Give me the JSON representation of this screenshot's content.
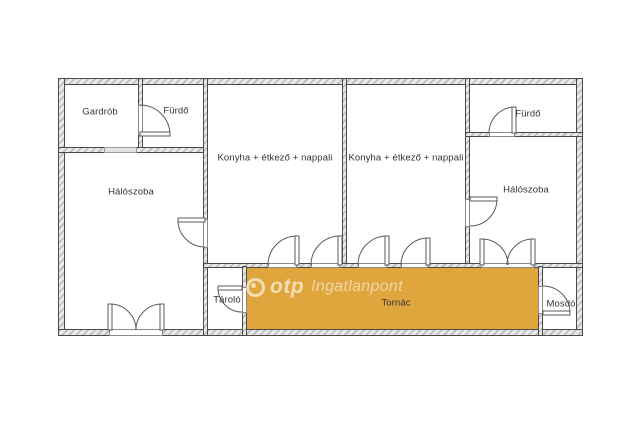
{
  "floor_plan": {
    "rooms": [
      {
        "label": "Gardrób"
      },
      {
        "label": "Fürdő"
      },
      {
        "label": "Hálószoba"
      },
      {
        "label": "Konyha + étkező + nappali"
      },
      {
        "label": "Konyha + étkező + nappali"
      },
      {
        "label": "Fürdő"
      },
      {
        "label": "Hálószoba"
      },
      {
        "label": "Tároló"
      },
      {
        "label": "Tornác"
      },
      {
        "label": "Mosdó"
      }
    ],
    "watermark": {
      "brand": "otp",
      "suffix": "Ingatlanpont"
    },
    "colors": {
      "porch_fill": "#E0A63E",
      "wall_line": "#4a4a4a",
      "wall_fill": "#e9e9e9",
      "label_text": "#333333",
      "background": "#ffffff"
    }
  }
}
